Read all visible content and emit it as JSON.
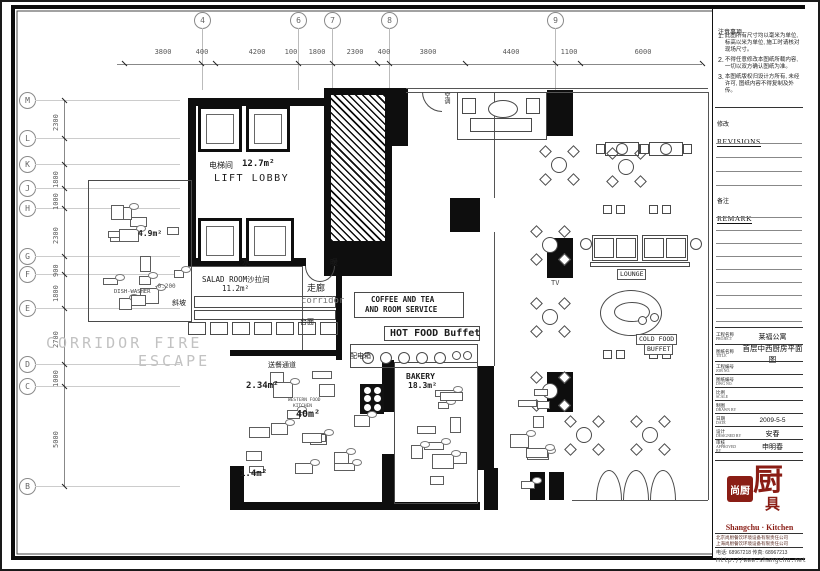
{
  "panel": {
    "notes": {
      "header": "注意事项",
      "items": [
        "此图所有尺寸均以毫米为单位, 标高以米为单位, 施工时请核对现场尺寸。",
        "不得任意修改本图纸所载内容, 一切以双方确认图纸为准。",
        "本图纸版权归设计方所有, 未经许可, 图纸内容不得复制及外传。"
      ]
    },
    "revisions": {
      "cn": "修改",
      "en": "REVISIONS"
    },
    "remark": {
      "cn": "备注",
      "en": "REMARK"
    },
    "titleblock": [
      {
        "cn": "工程名称",
        "en": "PROJECT",
        "value": "莱福公寓",
        "h": 17,
        "vs": 7
      },
      {
        "cn": "图纸名称",
        "en": "TITLE",
        "value": "首层中西厨房平面图",
        "h": 17,
        "vs": 7.5
      },
      {
        "cn": "工程编号",
        "en": "JOB NO.",
        "value": "",
        "h": 13,
        "vs": 6
      },
      {
        "cn": "图纸编号",
        "en": "DWG NO.",
        "value": "",
        "h": 13,
        "vs": 6
      },
      {
        "cn": "比例",
        "en": "SCALE",
        "value": "",
        "h": 13,
        "vs": 6
      },
      {
        "cn": "制图",
        "en": "DRAWN BY",
        "value": "",
        "h": 13,
        "vs": 6
      },
      {
        "cn": "日期",
        "en": "DATE",
        "value": "2009-5-5",
        "h": 13,
        "vs": 6.5
      },
      {
        "cn": "设计",
        "en": "DESIGNED BY",
        "value": "安春",
        "h": 13,
        "vs": 7
      },
      {
        "cn": "审核",
        "en": "APPROVED BY",
        "value": "申明春",
        "h": 13,
        "vs": 7
      }
    ],
    "logo": {
      "seal_text": "尚厨",
      "big_char": "厨",
      "sub_char": "具",
      "name": "Shangchu · Kitchen",
      "color": "#8a1d15",
      "company_lines": [
        "北京尚厨餐饮环境设备有限责任公司",
        "上海尚厨餐饮环境设备有限责任公司"
      ],
      "phone_line": "电话: 68967218    传真: 68967213",
      "url": "Http://www.shangchu.net"
    }
  },
  "grid": {
    "top_bubbles": [
      {
        "label": "4",
        "x": 200
      },
      {
        "label": "6",
        "x": 296
      },
      {
        "label": "7",
        "x": 330
      },
      {
        "label": "8",
        "x": 387
      },
      {
        "label": "9",
        "x": 553
      }
    ],
    "top_dims": [
      {
        "t": "3800",
        "x": 160
      },
      {
        "t": "400",
        "x": 199
      },
      {
        "t": "4200",
        "x": 254
      },
      {
        "t": "100",
        "x": 288
      },
      {
        "t": "1800",
        "x": 314
      },
      {
        "t": "2300",
        "x": 352
      },
      {
        "t": "400",
        "x": 381
      },
      {
        "t": "3800",
        "x": 425
      },
      {
        "t": "4400",
        "x": 508
      },
      {
        "t": "1100",
        "x": 566
      },
      {
        "t": "6000",
        "x": 640
      }
    ],
    "top_ticks": [
      122,
      199,
      213,
      296,
      330,
      375,
      387,
      463,
      553,
      578,
      700
    ],
    "left_bubbles": [
      {
        "label": "M",
        "y": 98
      },
      {
        "label": "L",
        "y": 136
      },
      {
        "label": "K",
        "y": 162
      },
      {
        "label": "J",
        "y": 186
      },
      {
        "label": "H",
        "y": 206
      },
      {
        "label": "G",
        "y": 254
      },
      {
        "label": "F",
        "y": 272
      },
      {
        "label": "E",
        "y": 306
      },
      {
        "label": "D",
        "y": 362
      },
      {
        "label": "C",
        "y": 384
      },
      {
        "label": "B",
        "y": 484
      }
    ],
    "left_dims": [
      {
        "t": "2300",
        "y": 117
      },
      {
        "t": "1800",
        "y": 174
      },
      {
        "t": "1000",
        "y": 196
      },
      {
        "t": "2300",
        "y": 230
      },
      {
        "t": "900",
        "y": 263
      },
      {
        "t": "1800",
        "y": 288
      },
      {
        "t": "2700",
        "y": 334
      },
      {
        "t": "1000",
        "y": 373
      },
      {
        "t": "5000",
        "y": 434
      }
    ],
    "left_ticks": [
      98,
      136,
      162,
      186,
      206,
      254,
      272,
      306,
      362,
      384,
      484
    ]
  },
  "plan": {
    "walls": [
      [
        186,
        96,
        136,
        8
      ],
      [
        288,
        96,
        34,
        8
      ],
      [
        186,
        96,
        8,
        168
      ],
      [
        186,
        256,
        118,
        8
      ],
      [
        322,
        86,
        68,
        188
      ],
      [
        390,
        86,
        16,
        58
      ],
      [
        545,
        88,
        26,
        46
      ],
      [
        545,
        236,
        26,
        40
      ],
      [
        448,
        196,
        30,
        34
      ],
      [
        476,
        364,
        16,
        104
      ],
      [
        545,
        370,
        26,
        40
      ],
      [
        228,
        464,
        14,
        44
      ],
      [
        228,
        500,
        250,
        8
      ],
      [
        380,
        358,
        12,
        52
      ],
      [
        380,
        452,
        12,
        56
      ],
      [
        482,
        466,
        14,
        42
      ],
      [
        528,
        470,
        15,
        28
      ],
      [
        547,
        470,
        15,
        28
      ],
      [
        334,
        266,
        6,
        92
      ],
      [
        228,
        348,
        108,
        6
      ]
    ],
    "hatch": [
      329,
      93,
      54,
      146
    ],
    "lifts": [
      [
        196,
        104,
        44,
        46
      ],
      [
        244,
        104,
        44,
        46
      ],
      [
        196,
        216,
        44,
        46
      ],
      [
        244,
        216,
        48,
        46
      ]
    ],
    "lines": [
      [
        404,
        86,
        706,
        86
      ],
      [
        404,
        90,
        706,
        90
      ],
      [
        706,
        90,
        706,
        498
      ],
      [
        570,
        498,
        706,
        498
      ],
      [
        300,
        264,
        300,
        348
      ],
      [
        492,
        90,
        492,
        196
      ],
      [
        492,
        230,
        492,
        364
      ],
      [
        86,
        178,
        190,
        178
      ],
      [
        186,
        264,
        300,
        264
      ]
    ],
    "outlines": [
      [
        352,
        290,
        110,
        26
      ],
      [
        382,
        324,
        96,
        15
      ],
      [
        348,
        342,
        128,
        24
      ],
      [
        192,
        294,
        142,
        12
      ],
      [
        192,
        308,
        142,
        10
      ],
      [
        186,
        320,
        18,
        13
      ],
      [
        208,
        320,
        18,
        13
      ],
      [
        230,
        320,
        18,
        13
      ],
      [
        252,
        320,
        18,
        13
      ],
      [
        274,
        320,
        18,
        13
      ],
      [
        296,
        320,
        18,
        13
      ],
      [
        318,
        320,
        18,
        13
      ],
      [
        86,
        178,
        104,
        142
      ],
      [
        392,
        360,
        84,
        142
      ],
      [
        455,
        90,
        90,
        48
      ],
      [
        460,
        96,
        14,
        16
      ],
      [
        524,
        96,
        14,
        16
      ],
      [
        468,
        116,
        62,
        14
      ],
      [
        590,
        233,
        46,
        26
      ],
      [
        640,
        233,
        46,
        26
      ],
      [
        592,
        236,
        20,
        20
      ],
      [
        614,
        236,
        20,
        20
      ],
      [
        642,
        236,
        20,
        20
      ],
      [
        664,
        236,
        20,
        20
      ],
      [
        588,
        260,
        100,
        5
      ],
      [
        614,
        322,
        16,
        8
      ]
    ],
    "ellipses": [
      [
        486,
        98,
        30,
        18
      ],
      [
        598,
        288,
        62,
        46
      ],
      [
        612,
        300,
        36,
        20
      ],
      [
        578,
        236,
        12,
        12
      ],
      [
        688,
        236,
        12,
        12
      ],
      [
        636,
        314,
        9,
        9
      ],
      [
        648,
        311,
        9,
        9
      ]
    ],
    "circles": [
      [
        360,
        350,
        12
      ],
      [
        378,
        350,
        12
      ],
      [
        396,
        350,
        12
      ],
      [
        414,
        350,
        12
      ],
      [
        432,
        350,
        12
      ],
      [
        450,
        349,
        9
      ],
      [
        461,
        349,
        9
      ]
    ],
    "round_tables": [
      [
        557,
        163
      ],
      [
        624,
        165
      ],
      [
        548,
        243
      ],
      [
        548,
        315
      ],
      [
        548,
        389
      ],
      [
        582,
        433
      ],
      [
        648,
        433
      ]
    ],
    "rect_tables": [
      [
        620,
        147
      ],
      [
        664,
        147
      ]
    ],
    "chair_pairs": [
      [
        612,
        207
      ],
      [
        658,
        207
      ],
      [
        612,
        352
      ],
      [
        658,
        352
      ]
    ],
    "semis_up": [
      [
        594,
        468
      ],
      [
        621,
        468
      ],
      [
        648,
        468
      ]
    ],
    "semi_down": [
      303,
      264,
      30,
      16
    ],
    "qarcs": [
      [
        420,
        90,
        20
      ]
    ],
    "stoves": [
      [
        358,
        382,
        24,
        30
      ]
    ],
    "zones": [
      [
        94,
        188,
        90,
        122,
        14,
        7
      ],
      [
        238,
        364,
        132,
        126,
        16,
        11
      ],
      [
        400,
        364,
        68,
        124,
        10,
        23
      ],
      [
        500,
        362,
        54,
        126,
        8,
        5
      ]
    ],
    "labels": [
      {
        "t": "电梯间",
        "x": 207,
        "y": 160,
        "s": 8
      },
      {
        "t": "12.7m²",
        "x": 240,
        "y": 158,
        "s": 9,
        "b": 1
      },
      {
        "t": "LIFT LOBBY",
        "x": 212,
        "y": 172,
        "s": 10,
        "sp": 1.5
      },
      {
        "t": "4.9m²",
        "x": 136,
        "y": 228,
        "s": 8,
        "b": 1
      },
      {
        "t": "水",
        "x": 240,
        "y": 257,
        "s": 8
      },
      {
        "t": "暖",
        "x": 328,
        "y": 257,
        "s": 8
      },
      {
        "t": "SALAD ROOM沙拉间",
        "x": 200,
        "y": 274,
        "s": 7.5
      },
      {
        "t": "11.2m²",
        "x": 220,
        "y": 283,
        "s": 7.5
      },
      {
        "t": "斜坡",
        "x": 170,
        "y": 298,
        "s": 7
      },
      {
        "t": "-0.200",
        "x": 152,
        "y": 282,
        "s": 6,
        "c": "#555"
      },
      {
        "t": "DISH-WASHER",
        "x": 112,
        "y": 288,
        "s": 5.5,
        "c": "#444"
      },
      {
        "t": "走廊",
        "x": 305,
        "y": 283,
        "s": 9
      },
      {
        "t": "corridor",
        "x": 299,
        "y": 295,
        "s": 9,
        "c": "#777"
      },
      {
        "t": "COFFEE AND TEA",
        "x": 369,
        "y": 294,
        "s": 7.5,
        "b": 1
      },
      {
        "t": "AND ROOM SERVICE",
        "x": 363,
        "y": 304,
        "s": 7.5,
        "b": 1
      },
      {
        "t": "HOT FOOD Buffet",
        "x": 388,
        "y": 327,
        "s": 10,
        "b": 1
      },
      {
        "t": "配电箱",
        "x": 348,
        "y": 351,
        "s": 7
      },
      {
        "t": "CORRIDOR FIRE",
        "x": 44,
        "y": 334,
        "s": 15,
        "c": "#c2c2c2",
        "sp": 3
      },
      {
        "t": "ESCAPE",
        "x": 136,
        "y": 352,
        "s": 15,
        "c": "#c2c2c2",
        "sp": 3
      },
      {
        "t": "送餐通道",
        "x": 266,
        "y": 360,
        "s": 7
      },
      {
        "t": "2.34m²",
        "x": 244,
        "y": 380,
        "s": 9,
        "b": 1
      },
      {
        "t": "WESTERN FOOD",
        "x": 286,
        "y": 397,
        "s": 4.5,
        "c": "#444"
      },
      {
        "t": "KITCHEN",
        "x": 291,
        "y": 403,
        "s": 4.5,
        "c": "#444"
      },
      {
        "t": "40m²",
        "x": 294,
        "y": 408,
        "s": 10,
        "b": 1
      },
      {
        "t": "BAKERY",
        "x": 404,
        "y": 371,
        "s": 8,
        "b": 1
      },
      {
        "t": "18.3m²",
        "x": 406,
        "y": 380,
        "s": 8,
        "b": 1
      },
      {
        "t": "1.4m²",
        "x": 238,
        "y": 468,
        "s": 9,
        "b": 1
      },
      {
        "t": "TV",
        "x": 549,
        "y": 278,
        "s": 7,
        "c": "#444"
      },
      {
        "t": "LOUNGE",
        "x": 615,
        "y": 267,
        "s": 6.5,
        "box": 1
      },
      {
        "t": "COLD FOOD",
        "x": 634,
        "y": 332,
        "s": 6.5,
        "box": 1
      },
      {
        "t": "BUFFET",
        "x": 642,
        "y": 342,
        "s": 6.5,
        "box": 1
      },
      {
        "t": "台面",
        "x": 298,
        "y": 317,
        "s": 7
      },
      {
        "t": "空调",
        "x": 441,
        "y": 90,
        "s": 6,
        "v": 1
      }
    ]
  }
}
